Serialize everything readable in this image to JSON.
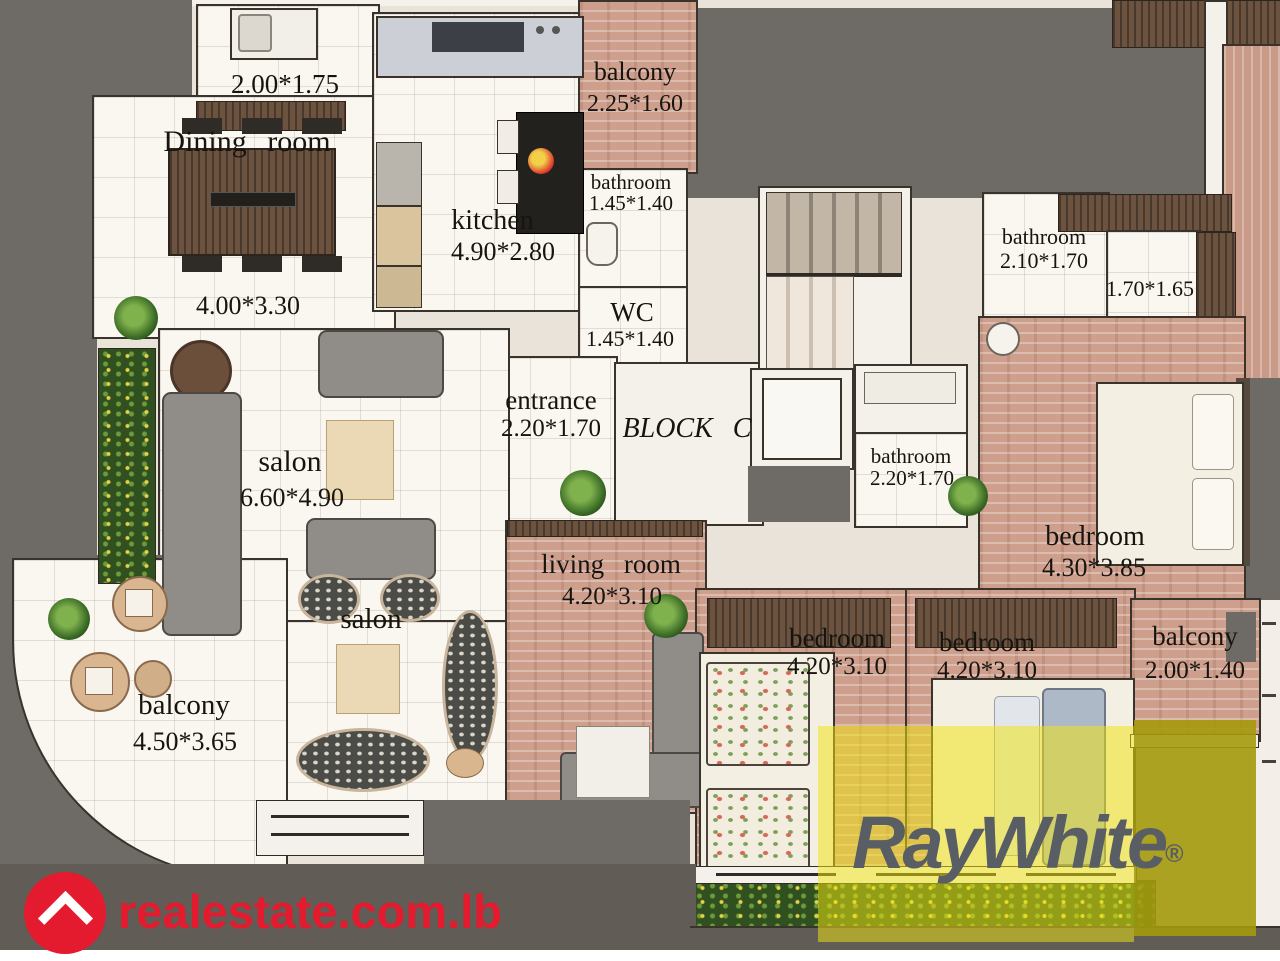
{
  "plan": {
    "block_label": "BLOCK C",
    "rooms": {
      "laundry": {
        "dims": "2.00*1.75"
      },
      "dining": {
        "name": "Dining room",
        "dims": "4.00*3.30"
      },
      "kitchen": {
        "name": "kitchen",
        "dims": "4.90*2.80"
      },
      "balcony_top": {
        "name": "balcony",
        "dims": "2.25*1.60"
      },
      "bathroom_top": {
        "name": "bathroom",
        "dims": "1.45*1.40"
      },
      "wc": {
        "name": "WC",
        "dims": "1.45*1.40"
      },
      "entrance": {
        "name": "entrance",
        "dims": "2.20*1.70"
      },
      "bathroom_right": {
        "name": "bathroom",
        "dims": "2.10*1.70"
      },
      "store": {
        "dims": "1.70*1.65"
      },
      "bathroom_master": {
        "name": "bathroom",
        "dims": "2.20*1.70"
      },
      "bedroom_master": {
        "name": "bedroom",
        "dims": "4.30*3.85"
      },
      "salon": {
        "name": "salon",
        "dims": "6.60*4.90"
      },
      "salon2": {
        "name": "salon"
      },
      "living": {
        "name": "living room",
        "dims": "4.20*3.10"
      },
      "bedroom_a": {
        "name": "bedroom",
        "dims": "4.20*3.10"
      },
      "bedroom_b": {
        "name": "bedroom",
        "dims": "4.20*3.10"
      },
      "balcony_right": {
        "name": "balcony",
        "dims": "2.00*1.40"
      },
      "balcony_main": {
        "name": "balcony",
        "dims": "4.50*3.65"
      }
    }
  },
  "branding": {
    "agency_logo": "RayWhite",
    "registered_mark": "®",
    "portal_logo": "realestate.com.lb"
  },
  "colors": {
    "exterior_gray": "#6e6a65",
    "wood_floor": "#cf9f8e",
    "dark_wood": "#6b5340",
    "overlay_yellow": "#f0e410",
    "overlay_olive": "#a49a0c",
    "brand_red": "#e41b2e",
    "agency_text_gray": "#595e65"
  }
}
